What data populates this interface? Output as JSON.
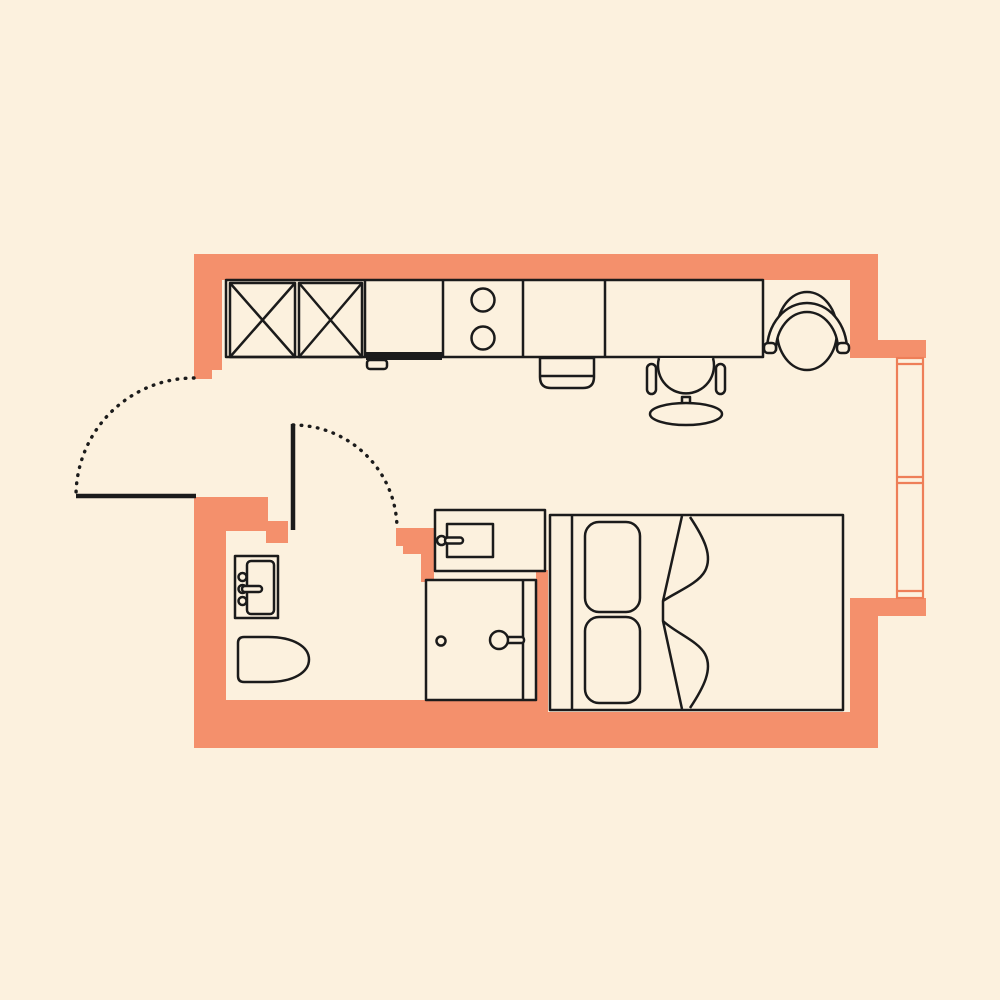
{
  "plan": {
    "type": "floor-plan",
    "subject": "studio-apartment",
    "rooms": [
      {
        "name": "main-room"
      },
      {
        "name": "entry-hall"
      },
      {
        "name": "bathroom"
      }
    ],
    "fixtures": [
      {
        "name": "wardrobe-left",
        "symbol": "crossed-box"
      },
      {
        "name": "wardrobe-right",
        "symbol": "crossed-box"
      },
      {
        "name": "oven",
        "symbol": "thick-door-bar-with-handle"
      },
      {
        "name": "cooktop",
        "symbol": "two-burner-circles"
      },
      {
        "name": "counter-stool",
        "symbol": "tucked-seat"
      },
      {
        "name": "desk",
        "symbol": "rectangle"
      },
      {
        "name": "desk-chair",
        "symbol": "seat-armrests-backrest-base"
      },
      {
        "name": "armchair",
        "symbol": "round-seat-with-wrap-back"
      },
      {
        "name": "window-bay",
        "symbol": "double-casement-window"
      },
      {
        "name": "entrance-door",
        "symbol": "leaf-with-dotted-swing-arc"
      },
      {
        "name": "interior-door",
        "symbol": "leaf-with-dotted-swing-arc"
      },
      {
        "name": "washbasin-unit",
        "symbol": "basin-with-tap"
      },
      {
        "name": "shower",
        "symbol": "stall-with-door-handle-and-drain"
      },
      {
        "name": "bathroom-sink",
        "symbol": "basin-with-tap-and-knobs"
      },
      {
        "name": "toilet",
        "symbol": "tank-and-bowl"
      },
      {
        "name": "bed",
        "symbol": "mattress-two-pillows-duvet-folds"
      }
    ]
  },
  "colors": {
    "background": "#FCF1DE",
    "wall_fill": "#F4906C",
    "line": "#1B1B1B",
    "window_outline": "#EE7F58",
    "floor": "#FCF1DE"
  }
}
